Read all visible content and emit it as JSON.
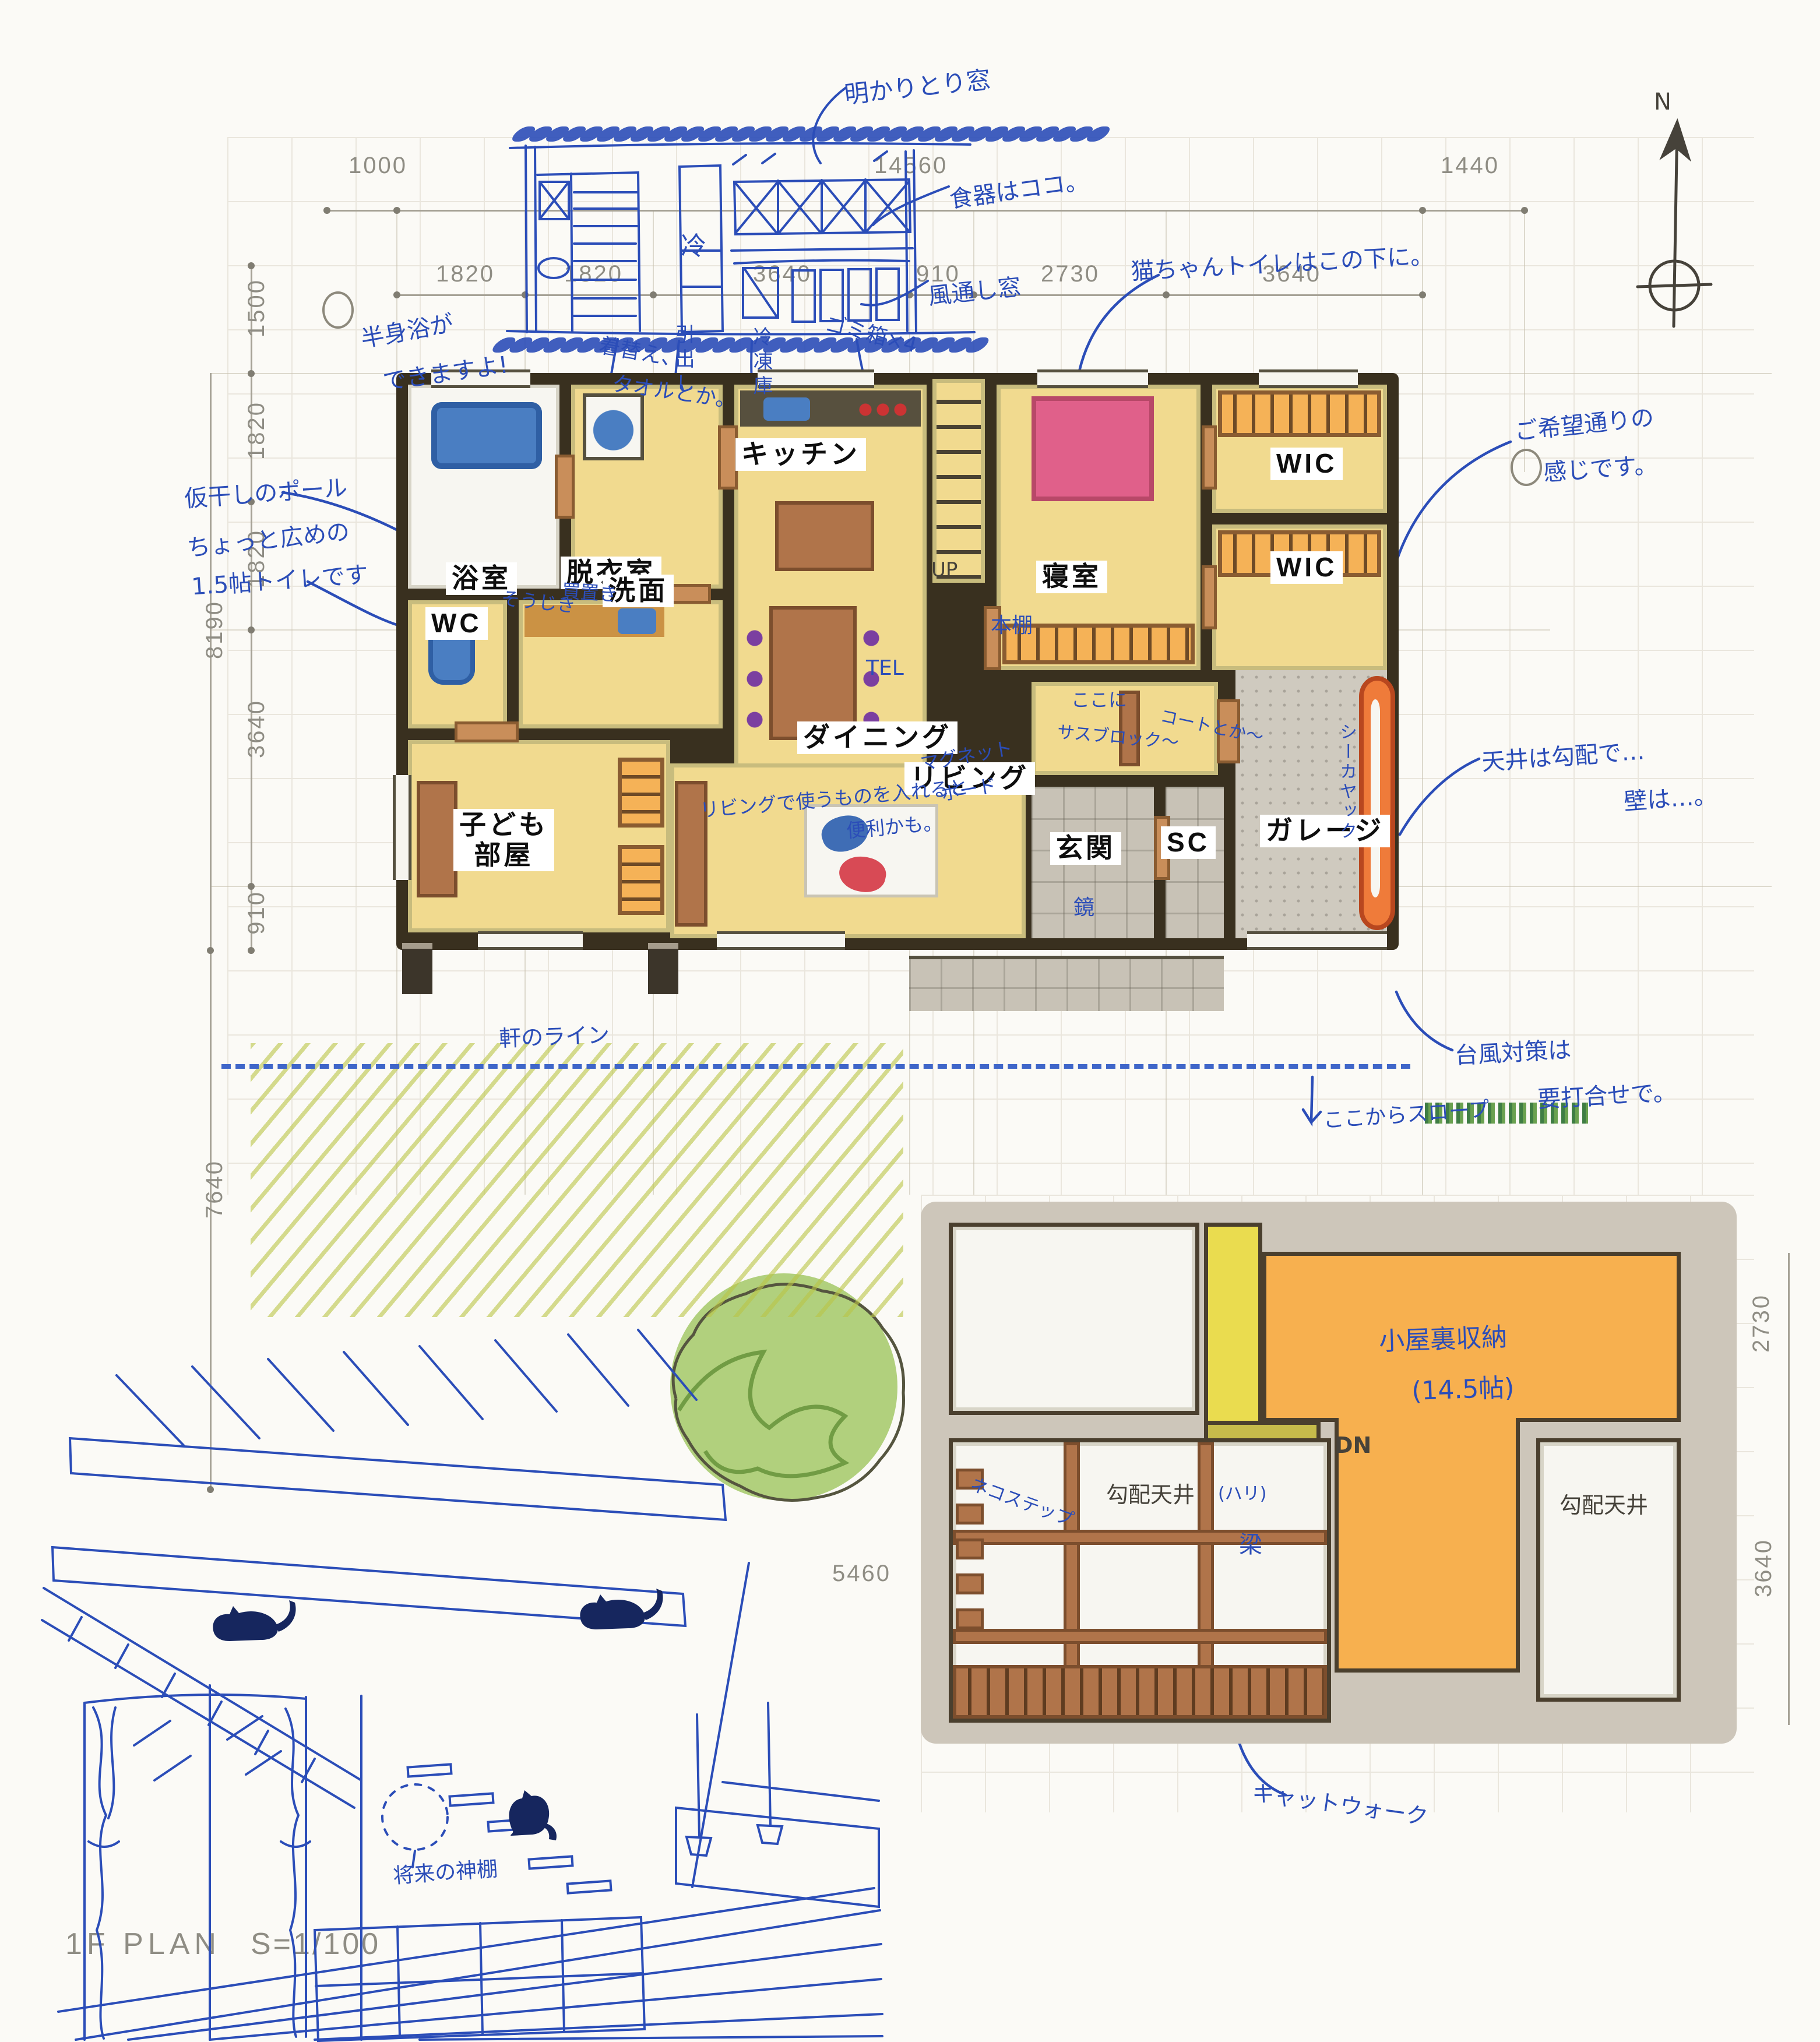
{
  "title": {
    "plan": "1F PLAN",
    "scale": "S=1/100"
  },
  "compass": {
    "n": "N"
  },
  "dims": {
    "lot_left": "1000",
    "overall": "14560",
    "lot_right": "1440",
    "top": [
      "1820",
      "1820",
      "3640",
      "910",
      "2730",
      "3640"
    ],
    "left": [
      "1500",
      "1820",
      "1820",
      "8190",
      "3640",
      "910",
      "7640"
    ],
    "attic_right_top": "2730",
    "attic_right_bottom": "3640",
    "attic_left": "5460"
  },
  "rooms": {
    "bath": "浴室",
    "dressing": "脱衣室",
    "kitchen": "キッチン",
    "wic": "WIC",
    "wc": "WC",
    "wash": "洗面",
    "bedroom": "寝室",
    "dining": "ダイニング",
    "kids1": "子ども",
    "kids2": "部屋",
    "living": "リビング",
    "entrance": "玄関",
    "sc": "SC",
    "garage": "ガレージ"
  },
  "stairs": {
    "up": "UP",
    "down": "DN"
  },
  "elevation_notes": {
    "skylight": "明かりとり窓",
    "dishes": "食器はココ。",
    "vent": "風通し窓",
    "fridge": "冷",
    "drawer": "引出し",
    "freezer": "冷凍庫",
    "trash": "ゴミ箱×4",
    "bath1": "半身浴が",
    "bath2": "できますよ!",
    "change1": "着替え、",
    "change2": "タオルとか。"
  },
  "plan_notes": {
    "pole": "仮干しのポール",
    "wc1": "ちょっと広めの",
    "wc2": "1.5帖トイレです",
    "vacuum": "そうじき",
    "stock": "買置き",
    "cat_toilet": "猫ちゃんトイレはこの下に。",
    "wish1": "ご希望通りの",
    "wish2": "感じです。",
    "bookshelf": "本棚",
    "tel": "TEL",
    "magnet1": "マグネット",
    "magnet2": "ボード",
    "living1": "リビングで使うものを入れると",
    "living2": "便利かも。",
    "entry1": "ここに",
    "entry2": "サスブロック〜",
    "entry3": "コートとか〜",
    "mirror": "鏡",
    "kayak": "シーカヤック",
    "ceil1": "天井は勾配で…",
    "ceil2": "壁は…。",
    "typhoon1": "台風対策は",
    "typhoon2": "要打合せで。",
    "eaves": "軒のライン",
    "slope": "ここからスロープ"
  },
  "attic_labels": {
    "storage1": "小屋裏収納",
    "storage2": "(14.5帖)",
    "sloped_l": "勾配天井",
    "sloped_r": "勾配天井",
    "beam1": "(ハリ)",
    "beam2": "梁",
    "catstep": "ネコステップ",
    "catwalk": "キャットウォーク"
  },
  "sketch_notes": {
    "kamidana": "将来の神棚"
  },
  "colors": {
    "ink": "#2b4db8",
    "floor": "#f1da8f",
    "closet": "#f5b257",
    "attic": "#f7b04f",
    "stone": "#c8c2b6",
    "wood": "#b0744a",
    "wall": "#39301f",
    "bed": "#e0608a",
    "lawn": "#bac446",
    "tree": "#8cc152",
    "kayak": "#e8622e"
  }
}
